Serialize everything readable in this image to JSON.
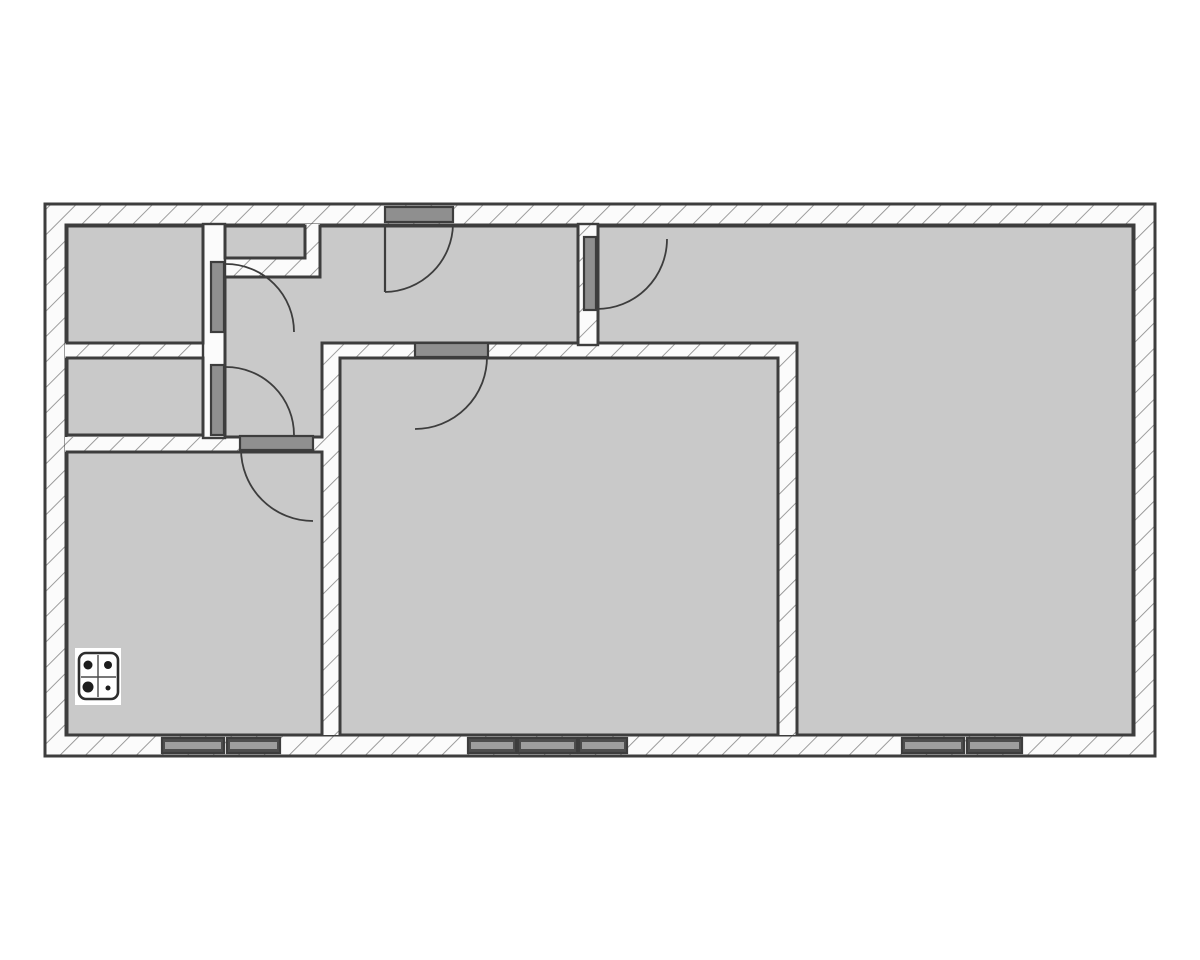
{
  "page": {
    "kind": "floor-plan-image",
    "background": "#ffffff"
  },
  "floorplan": {
    "canvas": {
      "w": 1200,
      "h": 960
    },
    "style": {
      "room_fill": "#c9c9c9",
      "wall_fill": "#fbfbfb",
      "hatch_line": "#8f8f8f",
      "hatch_line_w": 1.8,
      "hatch_spacing": 18,
      "outline": "#3d3d3d",
      "outline_w": 3,
      "wall_stroke_w": 2.4,
      "door_fill": "#8f8f8f",
      "bar_stroke_w": 2.2,
      "window_fill": "#4d4d4d",
      "window_stripe": "#9e9e9e",
      "arc_color": "#3d3d3d",
      "arc_w": 1.8,
      "leaf_w": 2.2
    },
    "outer_wall": {
      "x": 45,
      "y": 204,
      "w": 1110,
      "h": 552
    },
    "inner_field": {
      "x": 66,
      "y": 225,
      "w": 1068,
      "h": 510
    },
    "walls": [
      {
        "id": "wall-left-rooms-divider",
        "fill": "hatch",
        "x": 65,
        "y": 343,
        "w": 138,
        "h": 15,
        "stroke": false
      },
      {
        "id": "wall-kitchen-top",
        "fill": "hatch",
        "x": 65,
        "y": 437,
        "w": 275,
        "h": 15,
        "stroke": false
      },
      {
        "id": "wall-living-left",
        "fill": "hatch",
        "x": 322,
        "y": 343,
        "w": 18,
        "h": 392,
        "stroke": false
      },
      {
        "id": "wall-living-top",
        "fill": "hatch",
        "x": 322,
        "y": 343,
        "w": 475,
        "h": 15,
        "stroke": false
      },
      {
        "id": "wall-living-right",
        "fill": "hatch",
        "x": 778,
        "y": 343,
        "w": 19,
        "h": 392,
        "stroke": false
      },
      {
        "id": "wall-closet-right",
        "fill": "hatch",
        "x": 305,
        "y": 224,
        "w": 15,
        "h": 53,
        "stroke": false
      },
      {
        "id": "wall-closet-bottom",
        "fill": "hatch",
        "x": 225,
        "y": 258,
        "w": 95,
        "h": 19,
        "stroke": false
      },
      {
        "id": "wall-hall-left",
        "fill": "plain",
        "x": 203,
        "y": 224,
        "w": 22,
        "h": 214,
        "stroke": true
      },
      {
        "id": "wall-hall-right",
        "fill": "hatch",
        "x": 578,
        "y": 224,
        "w": 20,
        "h": 121,
        "stroke": true
      }
    ],
    "rooms": [
      {
        "id": "room-top-left",
        "points": [
          [
            67,
            226
          ],
          [
            203,
            226
          ],
          [
            203,
            343
          ],
          [
            67,
            343
          ]
        ]
      },
      {
        "id": "room-mid-left",
        "points": [
          [
            67,
            358
          ],
          [
            203,
            358
          ],
          [
            203,
            435
          ],
          [
            67,
            435
          ]
        ]
      },
      {
        "id": "room-kitchen",
        "points": [
          [
            67,
            452
          ],
          [
            322,
            452
          ],
          [
            322,
            735
          ],
          [
            67,
            735
          ]
        ]
      },
      {
        "id": "room-living",
        "points": [
          [
            340,
            358
          ],
          [
            778,
            358
          ],
          [
            778,
            735
          ],
          [
            340,
            735
          ]
        ]
      },
      {
        "id": "room-closet",
        "points": [
          [
            225,
            226
          ],
          [
            305,
            226
          ],
          [
            305,
            258
          ],
          [
            225,
            258
          ]
        ]
      },
      {
        "id": "room-right",
        "points": [
          [
            598,
            226
          ],
          [
            1133,
            226
          ],
          [
            1133,
            735
          ],
          [
            797,
            735
          ],
          [
            797,
            343
          ],
          [
            598,
            343
          ]
        ]
      },
      {
        "id": "room-hall",
        "points": [
          [
            320,
            226
          ],
          [
            578,
            226
          ],
          [
            578,
            343
          ],
          [
            322,
            343
          ],
          [
            322,
            437
          ],
          [
            225,
            437
          ],
          [
            225,
            277
          ],
          [
            320,
            277
          ]
        ]
      }
    ],
    "doors": [
      {
        "id": "door-entrance",
        "bar": {
          "x": 385,
          "y": 207,
          "w": 68,
          "h": 15
        },
        "leaf": "M 385 224 L 385 292",
        "arc": "M 385 292 A 69 69 0 0 0 453 224"
      },
      {
        "id": "door-top-left-room",
        "bar": {
          "x": 211,
          "y": 262,
          "w": 13,
          "h": 70
        },
        "arc": "M 226 264 A 68 68 0 0 1 294 332"
      },
      {
        "id": "door-mid-left-room",
        "bar": {
          "x": 211,
          "y": 365,
          "w": 13,
          "h": 70
        },
        "arc": "M 226 367 A 68 68 0 0 1 294 435"
      },
      {
        "id": "door-kitchen",
        "bar": {
          "x": 240,
          "y": 436,
          "w": 73,
          "h": 14
        },
        "arc": "M 241 449 A 72 72 0 0 0 313 521"
      },
      {
        "id": "door-living",
        "bar": {
          "x": 415,
          "y": 343,
          "w": 73,
          "h": 14
        },
        "arc": "M 487 357 A 72 72 0 0 1 415 429"
      },
      {
        "id": "door-right-room",
        "bar": {
          "x": 584,
          "y": 237,
          "w": 12,
          "h": 73
        },
        "arc": "M 597 309 A 70 70 0 0 0 667 239"
      }
    ],
    "windows": [
      {
        "id": "window-kitchen-1",
        "x": 162,
        "y": 738,
        "w": 62,
        "h": 15
      },
      {
        "id": "window-kitchen-2",
        "x": 227,
        "y": 738,
        "w": 53,
        "h": 15
      },
      {
        "id": "window-living-1",
        "x": 468,
        "y": 738,
        "w": 48,
        "h": 15
      },
      {
        "id": "window-living-2",
        "x": 518,
        "y": 738,
        "w": 59,
        "h": 15
      },
      {
        "id": "window-living-3",
        "x": 579,
        "y": 738,
        "w": 48,
        "h": 15
      },
      {
        "id": "window-right-1",
        "x": 902,
        "y": 738,
        "w": 62,
        "h": 15
      },
      {
        "id": "window-right-2",
        "x": 967,
        "y": 738,
        "w": 55,
        "h": 15
      }
    ],
    "stove": {
      "bg": {
        "x": 75,
        "y": 648,
        "w": 46,
        "h": 57
      },
      "body": {
        "x": 79,
        "y": 653,
        "w": 39,
        "h": 46,
        "rx": 7
      },
      "lines": [
        "M 98 655 L 98 697",
        "M 81 677 L 116 677"
      ],
      "burners": [
        {
          "cx": 88,
          "cy": 665,
          "r": 4.5
        },
        {
          "cx": 108,
          "cy": 665,
          "r": 4
        },
        {
          "cx": 88,
          "cy": 687,
          "r": 5.5
        },
        {
          "cx": 108,
          "cy": 688,
          "r": 2.5
        }
      ]
    }
  }
}
